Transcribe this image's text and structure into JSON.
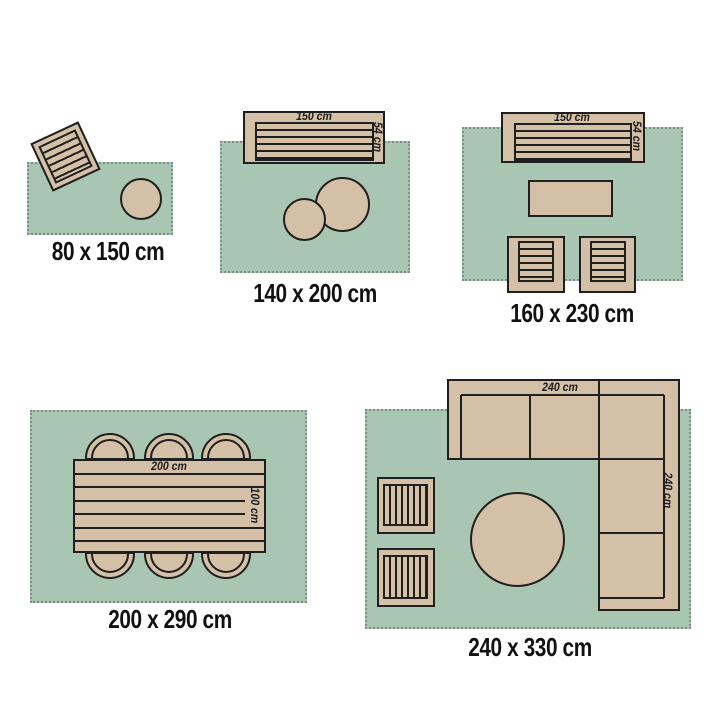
{
  "colors": {
    "rug": "#a9c6b3",
    "rug_border": "#7d9183",
    "furniture": "#d4c0a6",
    "outline": "#1f1f1f",
    "background": "#ffffff"
  },
  "scenes": [
    {
      "name": "rug-80x150",
      "title": "80 x 150 cm"
    },
    {
      "name": "rug-140x200",
      "title": "140 x 200 cm",
      "labels": {
        "width": "150 cm",
        "depth": "54 cm"
      }
    },
    {
      "name": "rug-160x230",
      "title": "160 x 230 cm",
      "labels": {
        "width": "150 cm",
        "depth": "54 cm"
      }
    },
    {
      "name": "rug-200x290",
      "title": "200 x 290 cm",
      "labels": {
        "width": "200 cm",
        "depth": "100 cm"
      }
    },
    {
      "name": "rug-240x330",
      "title": "240 x 330 cm",
      "labels": {
        "width": "240 cm",
        "depth": "240 cm"
      }
    }
  ]
}
